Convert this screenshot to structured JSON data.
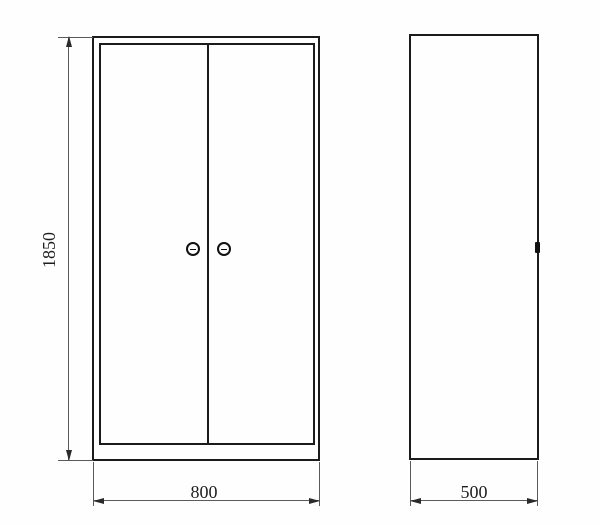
{
  "drawing": {
    "background_color": "#fefefe",
    "outline_color": "#1b1b1b",
    "dimension_line_color": "#5a5a5a",
    "views": {
      "front": {
        "door_count": 2,
        "handle_count": 2
      },
      "side": {
        "handle_count": 1
      }
    },
    "dimensions": {
      "height": {
        "label": "1850"
      },
      "width": {
        "label": "800"
      },
      "depth": {
        "label": "500"
      }
    },
    "icons": {
      "door_handle": "round-slot-handle-icon",
      "side_handle": "handle-profile-icon"
    }
  }
}
